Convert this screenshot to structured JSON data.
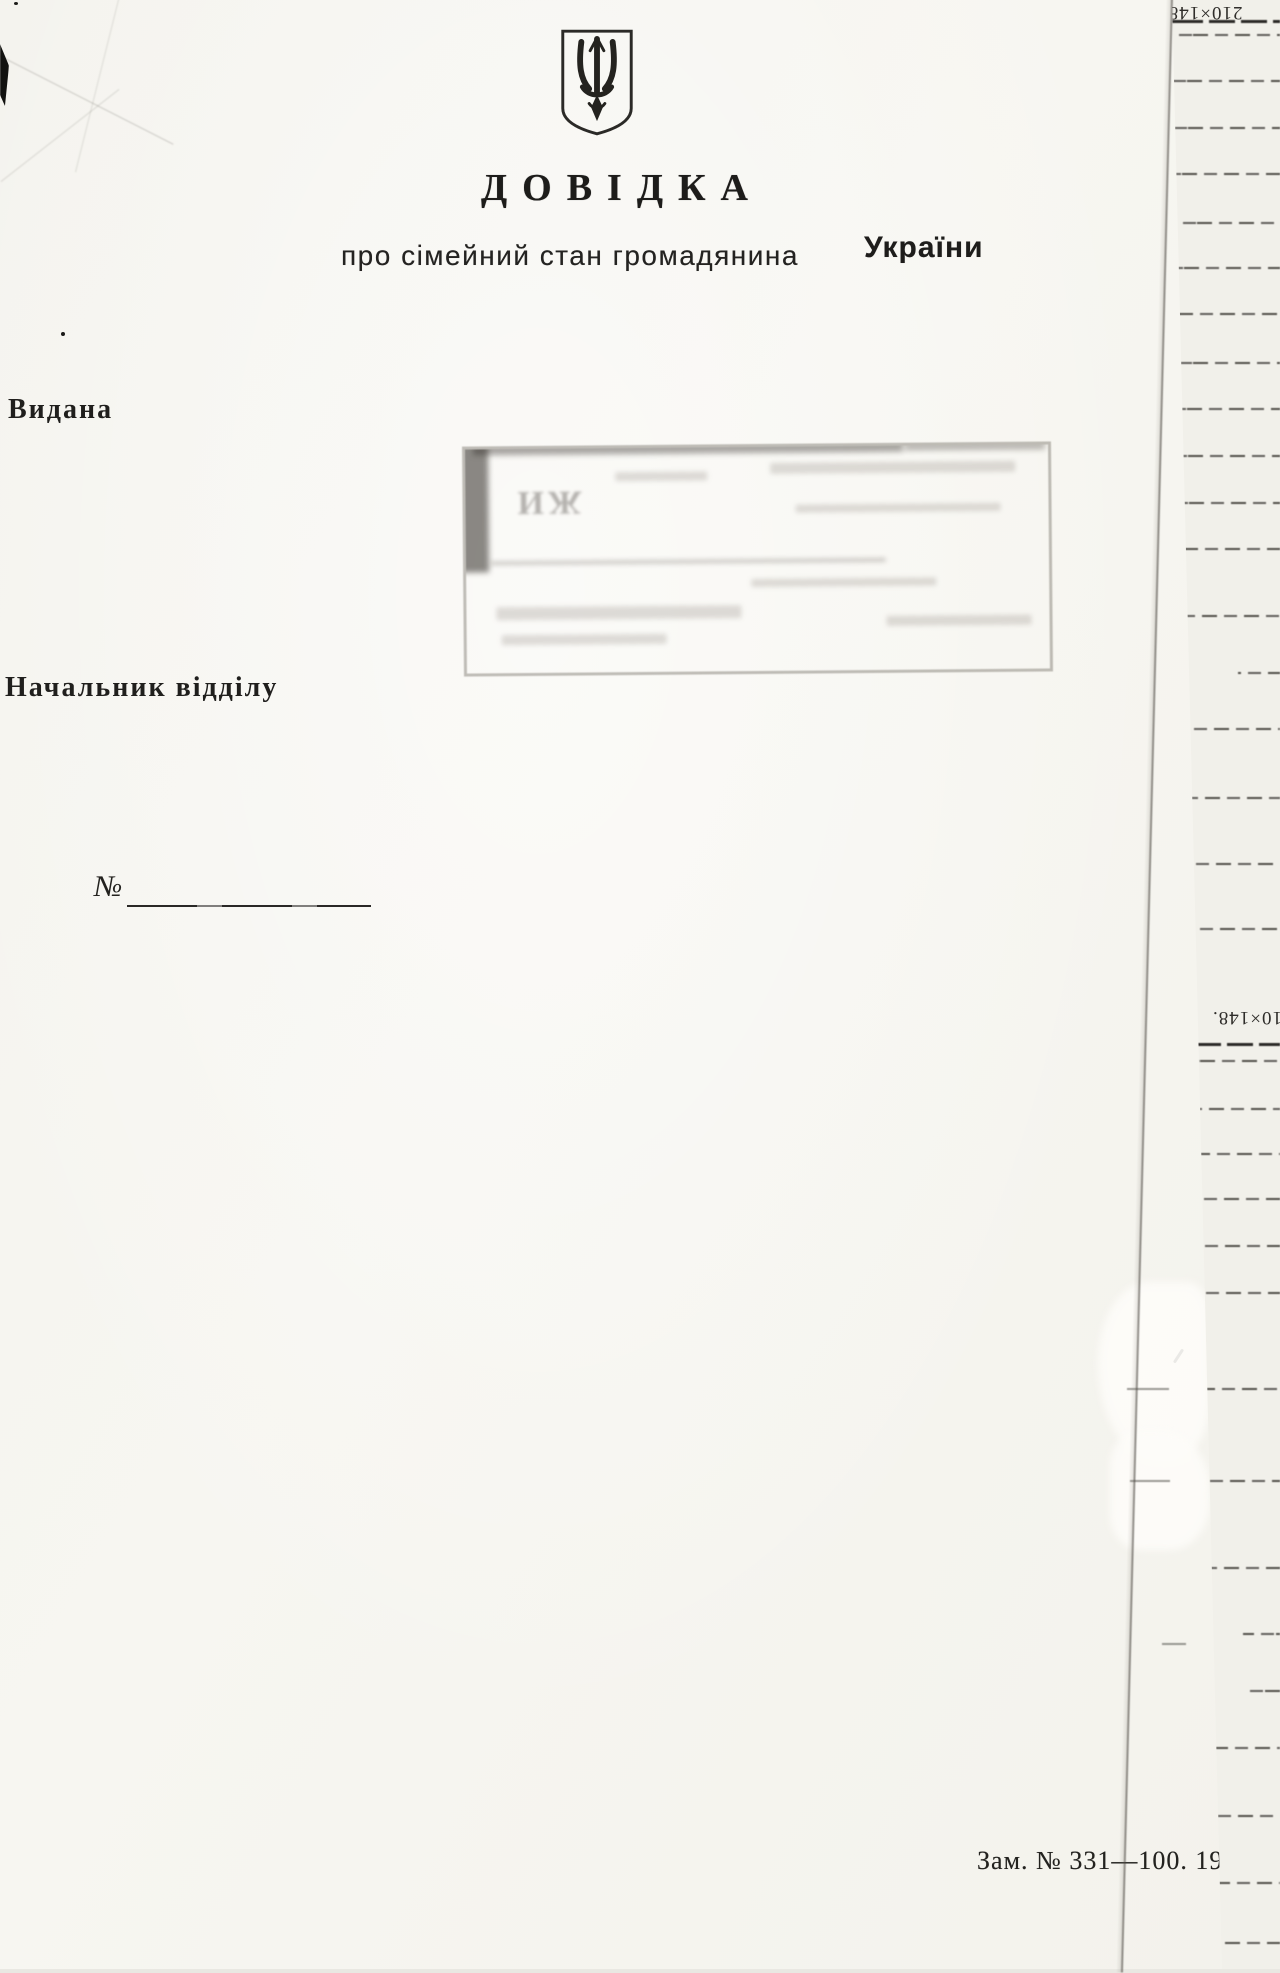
{
  "document": {
    "emblem": "ukraine-trident-coat-of-arms",
    "title": "ДОВІДКА",
    "subtitle": "про сімейний стан громадянина",
    "country": "України",
    "issued_label": "Видана",
    "signature_label": "Начальник відділу",
    "number_label": "№",
    "number_value": "",
    "print_imprint": "Зам. № 331—100. 19"
  },
  "stamp": {
    "legibility": "illegible-faint-ink",
    "fragment": "ЖИ"
  },
  "right_sheet": {
    "size_label_top": "210×148.",
    "size_label_mid": "210×148.",
    "rule_lines": [
      {
        "y": 20,
        "dark": true
      },
      {
        "y": 34
      },
      {
        "y": 80
      },
      {
        "y": 127
      },
      {
        "y": 173
      },
      {
        "y": 222
      },
      {
        "y": 267
      },
      {
        "y": 313
      },
      {
        "y": 362
      },
      {
        "y": 408
      },
      {
        "y": 455
      },
      {
        "y": 502
      },
      {
        "y": 548
      },
      {
        "y": 615
      },
      {
        "y": 672,
        "x": 1238
      },
      {
        "y": 728
      },
      {
        "y": 797
      },
      {
        "y": 863
      },
      {
        "y": 928
      },
      {
        "y": 1043,
        "dark": true
      },
      {
        "y": 1060
      },
      {
        "y": 1108
      },
      {
        "y": 1153
      },
      {
        "y": 1198
      },
      {
        "y": 1245
      },
      {
        "y": 1292
      },
      {
        "y": 1388
      },
      {
        "y": 1480
      },
      {
        "y": 1567
      },
      {
        "y": 1633,
        "x": 1243
      },
      {
        "y": 1690,
        "x": 1243
      },
      {
        "y": 1747
      },
      {
        "y": 1815
      },
      {
        "y": 1882
      },
      {
        "y": 1942
      }
    ]
  },
  "marks": {
    "pencil_dashes": [
      {
        "x": 1127,
        "y": 1388,
        "w": 42
      },
      {
        "x": 1130,
        "y": 1480,
        "w": 40
      },
      {
        "x": 1162,
        "y": 1643,
        "w": 24
      }
    ]
  }
}
